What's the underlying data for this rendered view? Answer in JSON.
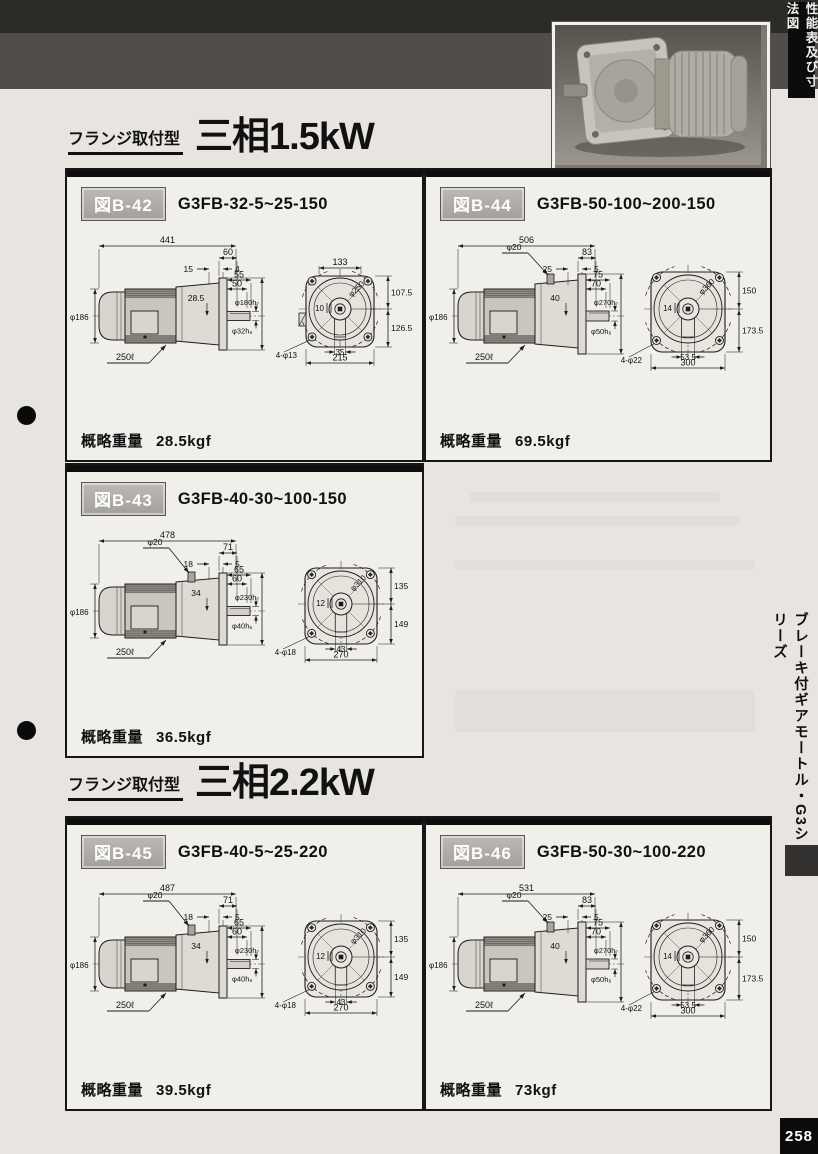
{
  "page": {
    "corner_tab": "性能表及び寸法図",
    "sidebar_label": "ブレーキ付ギアモートル・G3シリーズ",
    "page_number": "258"
  },
  "sections": [
    {
      "type_label": "フランジ取付型",
      "power_label": "三相1.5kW"
    },
    {
      "type_label": "フランジ取付型",
      "power_label": "三相2.2kW"
    }
  ],
  "figures": [
    {
      "fig_label": "図B-42",
      "model": "G3FB-32-5~25-150",
      "weight_label": "概略重量",
      "weight": "28.5kgf",
      "side": {
        "overall": "441",
        "flange_depth": "60",
        "a": "15",
        "b": "4",
        "l1": "55",
        "l2": "50",
        "spigot": "φ180h₇",
        "center_h": "28.5",
        "shaft": "φ32h₆",
        "motor_dia": "φ186",
        "cable": "250ℓ"
      },
      "front": {
        "top": "133",
        "upper": "107.5",
        "lower": "126.5",
        "bolt_circle": "φ250",
        "offset": "10",
        "key": "35",
        "width": "215",
        "holes": "4-φ13"
      }
    },
    {
      "fig_label": "図B-44",
      "model": "G3FB-50-100~200-150",
      "weight_label": "概略重量",
      "weight": "69.5kgf",
      "side": {
        "overall": "506",
        "flange_depth": "83",
        "a": "25",
        "b": "5",
        "l1": "75",
        "l2": "70",
        "spigot": "φ270h₇",
        "center_h": "40",
        "shaft": "φ50h₆",
        "motor_dia": "φ186",
        "cable": "250ℓ",
        "bolt": "φ20"
      },
      "front": {
        "upper": "150",
        "lower": "173.5",
        "bolt_circle": "φ360",
        "offset": "14",
        "key": "53.5",
        "width": "300",
        "holes": "4-φ22"
      }
    },
    {
      "fig_label": "図B-43",
      "model": "G3FB-40-30~100-150",
      "weight_label": "概略重量",
      "weight": "36.5kgf",
      "side": {
        "overall": "478",
        "flange_depth": "71",
        "a": "18",
        "b": "5",
        "l1": "65",
        "l2": "60",
        "spigot": "φ230h₇",
        "center_h": "34",
        "shaft": "φ40h₆",
        "motor_dia": "φ186",
        "cable": "250ℓ",
        "bolt": "φ20"
      },
      "front": {
        "upper": "135",
        "lower": "149",
        "bolt_circle": "φ310",
        "offset": "12",
        "key": "43",
        "width": "270",
        "holes": "4-φ18"
      }
    },
    {
      "fig_label": "図B-45",
      "model": "G3FB-40-5~25-220",
      "weight_label": "概略重量",
      "weight": "39.5kgf",
      "side": {
        "overall": "487",
        "flange_depth": "71",
        "a": "18",
        "b": "5",
        "l1": "65",
        "l2": "60",
        "spigot": "φ230h₇",
        "center_h": "34",
        "shaft": "φ40h₆",
        "motor_dia": "φ186",
        "cable": "250ℓ",
        "bolt": "φ20"
      },
      "front": {
        "upper": "135",
        "lower": "149",
        "bolt_circle": "φ310",
        "offset": "12",
        "key": "43",
        "width": "270",
        "holes": "4-φ18"
      }
    },
    {
      "fig_label": "図B-46",
      "model": "G3FB-50-30~100-220",
      "weight_label": "概略重量",
      "weight": "73kgf",
      "side": {
        "overall": "531",
        "flange_depth": "83",
        "a": "25",
        "b": "5",
        "l1": "75",
        "l2": "70",
        "spigot": "φ270h₇",
        "center_h": "40",
        "shaft": "φ50h₆",
        "motor_dia": "φ186",
        "cable": "250ℓ",
        "bolt": "φ20"
      },
      "front": {
        "upper": "150",
        "lower": "173.5",
        "bolt_circle": "φ360",
        "offset": "14",
        "key": "53.5",
        "width": "300",
        "holes": "4-φ22"
      }
    }
  ]
}
